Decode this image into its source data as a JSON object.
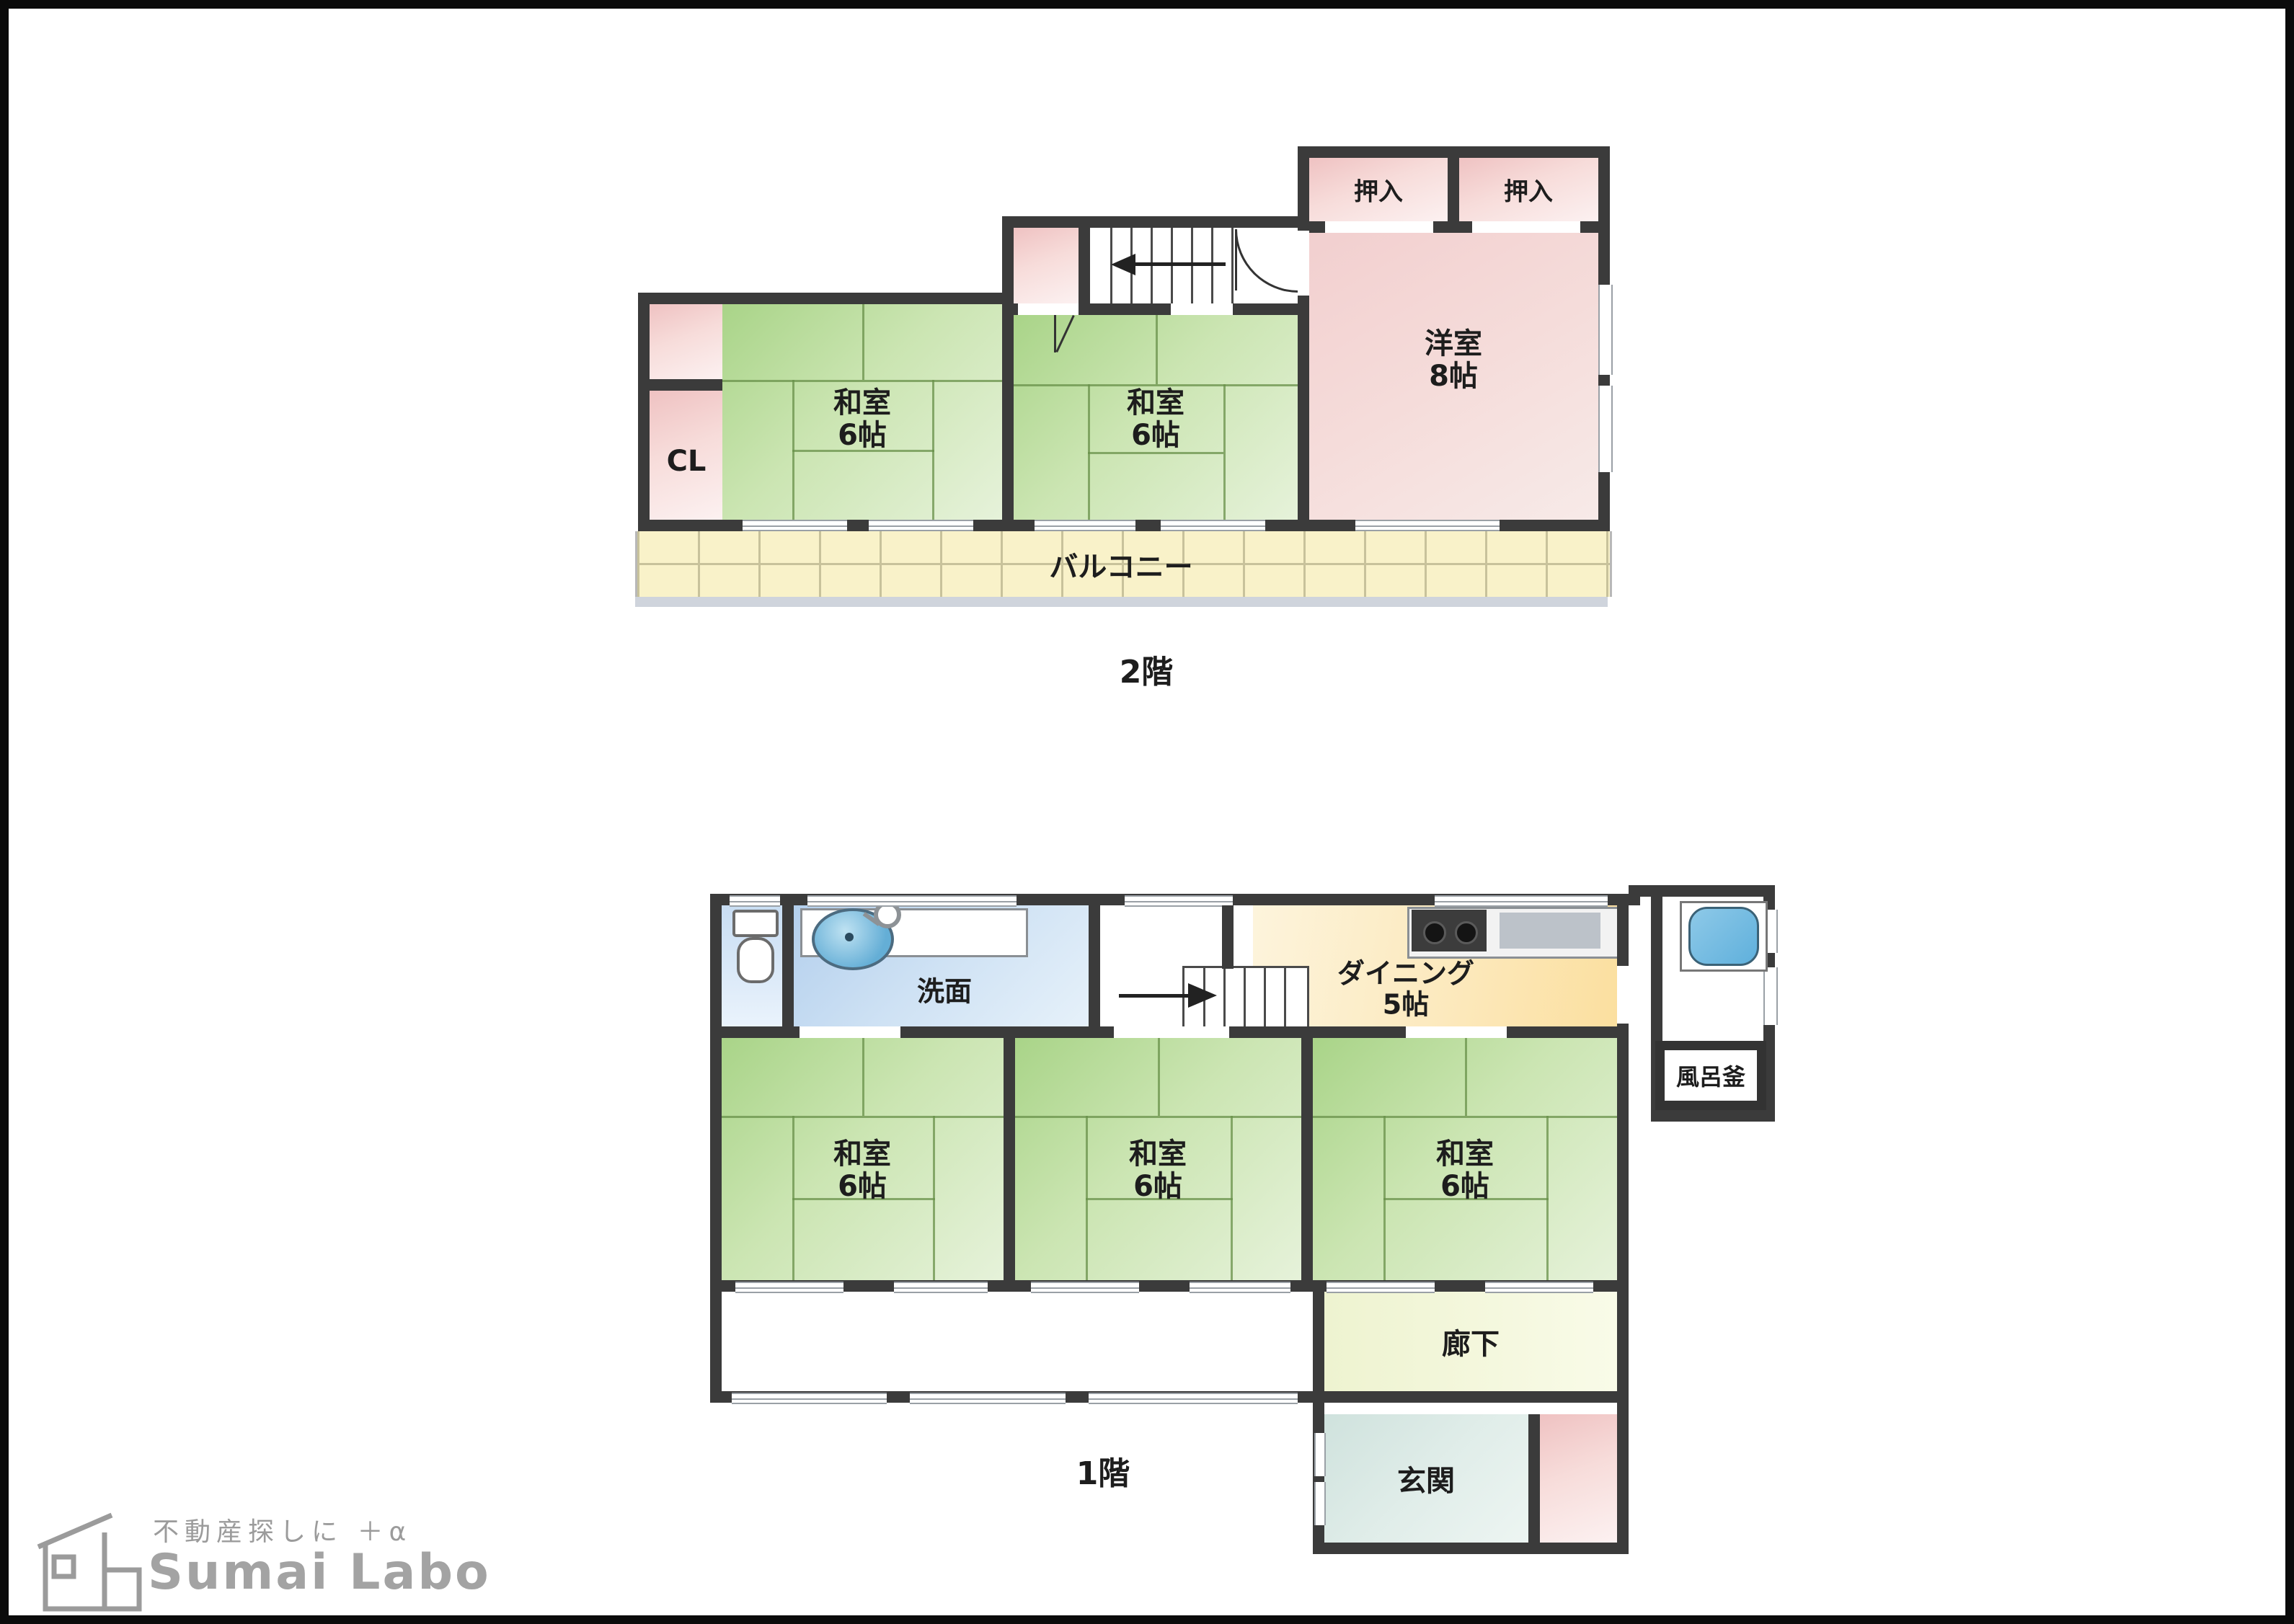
{
  "floor2": {
    "floor_label": "2階",
    "oshiire_left": "押入",
    "oshiire_right": "押入",
    "yoshitsu": {
      "name": "洋室",
      "size": "8帖"
    },
    "washitsu_left": {
      "name": "和室",
      "size": "6帖"
    },
    "washitsu_right": {
      "name": "和室",
      "size": "6帖"
    },
    "closet": "CL",
    "balcony": "バルコニー"
  },
  "floor1": {
    "floor_label": "1階",
    "senmen": "洗面",
    "dining": {
      "name": "ダイニング",
      "size": "5帖"
    },
    "washitsu_a": {
      "name": "和室",
      "size": "6帖"
    },
    "washitsu_b": {
      "name": "和室",
      "size": "6帖"
    },
    "washitsu_c": {
      "name": "和室",
      "size": "6帖"
    },
    "rouka": "廊下",
    "genkan": "玄関",
    "furogama": "風呂釜"
  },
  "logo": {
    "tagline": "不動産探しに ＋α",
    "brand": "Sumai Labo"
  },
  "colors": {
    "wall": "#3b3b3b",
    "tatami_green": "#a9d488",
    "room_pink": "#efc2c2",
    "dining_yellow": "#fbdf9f",
    "water_blue": "#b3cfed",
    "balcony_cream": "#f9f2c9",
    "logo_gray": "#9b9b9b"
  }
}
